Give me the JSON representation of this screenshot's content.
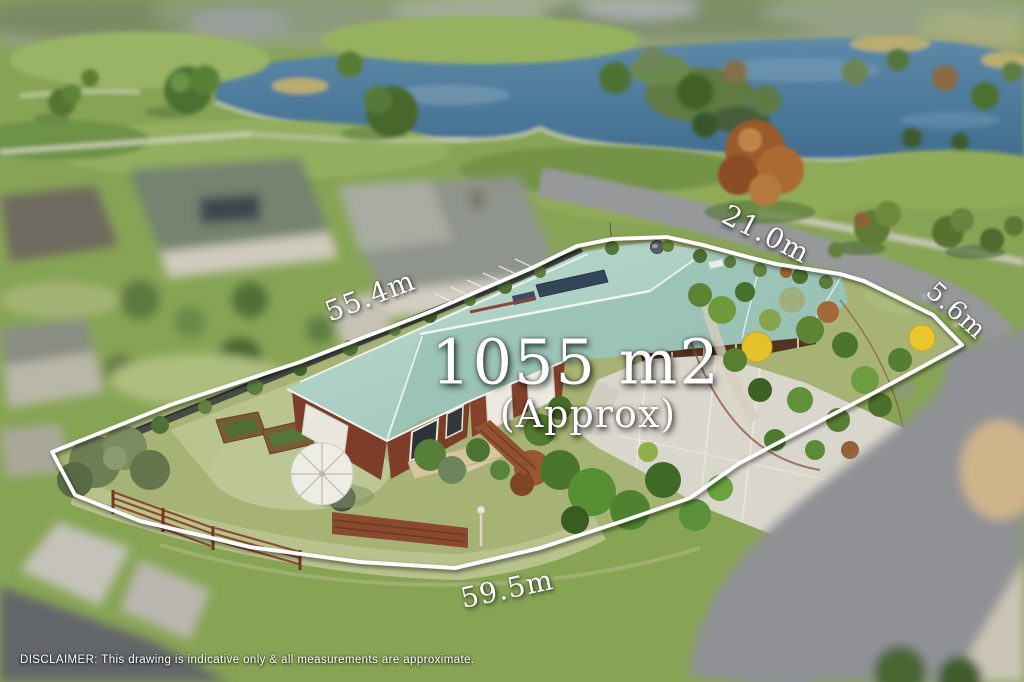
{
  "overlay": {
    "boundary_points": "52,452 170,405 300,362 432,311 532,268 577,246 612,239 667,237 703,245 752,258 776,264 840,274 864,281 933,315 962,345 920,368 870,395 820,421 770,447 738,464 690,498 620,522 540,548 455,568 360,562 250,547 140,521 75,495",
    "boundary_color": "#ffffff",
    "area": {
      "label": "1055 m2",
      "qualifier": "(Approx)"
    },
    "measurements": [
      {
        "id": "rear-boundary",
        "label": "55.4m"
      },
      {
        "id": "top-boundary",
        "label": "21.0m"
      },
      {
        "id": "corner-splay",
        "label": "5.6m"
      },
      {
        "id": "front-boundary",
        "label": "59.5m"
      }
    ],
    "disclaimer": "DISCLAIMER: This drawing is indicative only & all measurements are approximate."
  },
  "scene": {
    "description": "Aerial drone photo of a corner property: house with seafoam metal roof, gardens, driveway, white boundary outline, parkland lake beyond, blurred neighbouring houses and roads",
    "colors": {
      "water": "#4d7ba3",
      "park_grass": "#87a455",
      "yard_grass": "#a6b375",
      "roof": "#a5cbbf",
      "brick": "#7e3d29",
      "driveway": "#d9d6cc",
      "road": "#8f9194",
      "rust_tree": "#9a5a2c",
      "boundary": "#ffffff"
    }
  }
}
